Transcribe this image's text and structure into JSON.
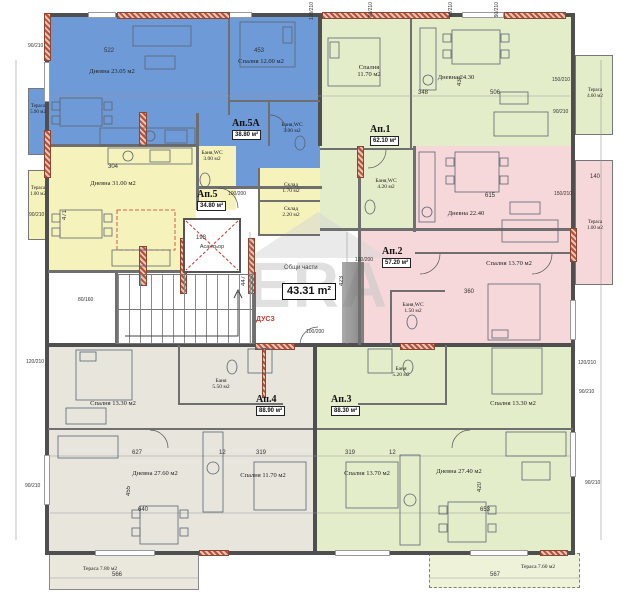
{
  "plan": {
    "watermark": "ERA",
    "common": {
      "label": "Общи части",
      "area": "43.31 m²",
      "note": "ДУСЗ",
      "elevator": "Асансьор"
    },
    "apartments": [
      {
        "name": "Ап.5А",
        "area": "38.80 м²"
      },
      {
        "name": "Ап.5",
        "area": "34.80 м²"
      },
      {
        "name": "Ап.1",
        "area": "62.10 м²"
      },
      {
        "name": "Ап.2",
        "area": "57.20 м²"
      },
      {
        "name": "Ап.4",
        "area": "88.90 м²"
      },
      {
        "name": "Ап.3",
        "area": "88.30 м²"
      }
    ],
    "rooms": [
      {
        "label": "Дневна 23.05 м2"
      },
      {
        "label": "Спалня 12.00 м2"
      },
      {
        "label": "Баня,WC\n3.00 м2"
      },
      {
        "label": "Тераса\n5.90 м2"
      },
      {
        "label": "Дневна 31.00 м2"
      },
      {
        "label": "Баня,WC\n3.00 м2"
      },
      {
        "label": "Склад\n1.70 м2"
      },
      {
        "label": "Склад\n2.20 м2"
      },
      {
        "label": "Тераса\n1.00 м2"
      },
      {
        "label": "Спалня\n11.70 м2"
      },
      {
        "label": "Дневна 24.30"
      },
      {
        "label": "Баня,WC\n4.20 м2"
      },
      {
        "label": "Тераса\n4.60 м2"
      },
      {
        "label": "Дневна 22.40"
      },
      {
        "label": "Спалня 13.70 м2"
      },
      {
        "label": "Баня,WC\n1.50 м2"
      },
      {
        "label": "Тераса\n1.00 м2"
      },
      {
        "label": "Спалня 13.30 м2"
      },
      {
        "label": "Баня\n5.50 м2"
      },
      {
        "label": "Дневна 27.60 м2"
      },
      {
        "label": "Спалня 11.70 м2"
      },
      {
        "label": "Баня\n5.20 м2"
      },
      {
        "label": "Спалня 13.30 м2"
      },
      {
        "label": "Спалня 13.70 м2"
      },
      {
        "label": "Дневна 27.40 м2"
      },
      {
        "label": "Тераса 7.80 м2"
      },
      {
        "label": "Тераса 7.60 м2"
      }
    ],
    "dims": [
      {
        "t": "522"
      },
      {
        "t": "453"
      },
      {
        "t": "348"
      },
      {
        "t": "506"
      },
      {
        "t": "434"
      },
      {
        "t": "304"
      },
      {
        "t": "471"
      },
      {
        "t": "615"
      },
      {
        "t": "447"
      },
      {
        "t": "423"
      },
      {
        "t": "198"
      },
      {
        "t": "627"
      },
      {
        "t": "12"
      },
      {
        "t": "319"
      },
      {
        "t": "319"
      },
      {
        "t": "12"
      },
      {
        "t": "640"
      },
      {
        "t": "653"
      },
      {
        "t": "566"
      },
      {
        "t": "567"
      },
      {
        "t": "455"
      },
      {
        "t": "420"
      },
      {
        "t": "120/210"
      },
      {
        "t": "90/210"
      },
      {
        "t": "90/210"
      },
      {
        "t": "90/210"
      },
      {
        "t": "150/210"
      },
      {
        "t": "90/210"
      },
      {
        "t": "150/210"
      },
      {
        "t": "120/210"
      },
      {
        "t": "90/210"
      },
      {
        "t": "90/210"
      },
      {
        "t": "120/210"
      },
      {
        "t": "90/210"
      },
      {
        "t": "90/210"
      },
      {
        "t": "80/160"
      },
      {
        "t": "100/200"
      },
      {
        "t": "100/200"
      },
      {
        "t": "90/210"
      },
      {
        "t": "140"
      },
      {
        "t": "360"
      },
      {
        "t": "100/200"
      }
    ]
  }
}
